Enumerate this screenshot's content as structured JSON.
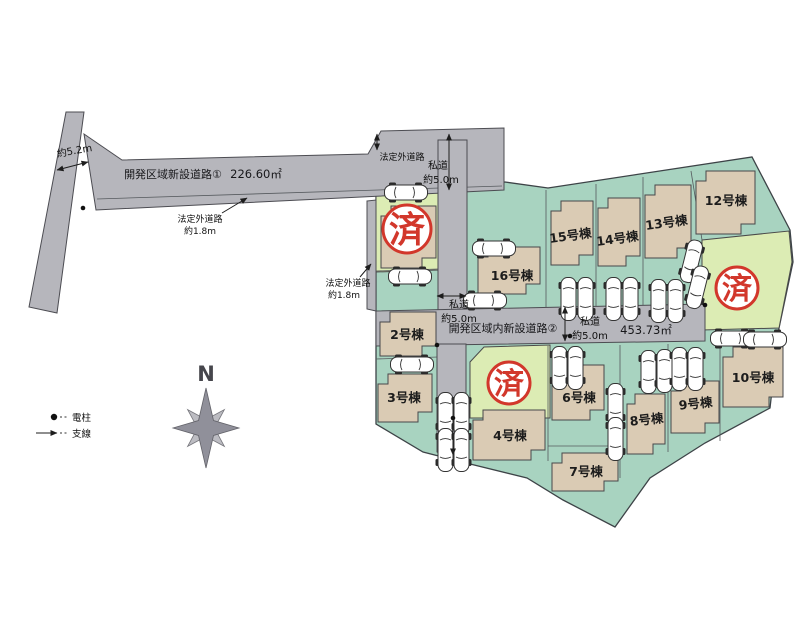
{
  "colors": {
    "lot_green": "#a8d3c0",
    "lot_sold_yellow": "#dcecb4",
    "road_gray": "#b6b6bc",
    "building_tan": "#dacbb4",
    "stamp_red": "#d2372b"
  },
  "roads": {
    "road1_name": "開発区域新設道路①",
    "road1_area": "226.60㎡",
    "road2_name": "開発区域内新設道路②",
    "road2_area": "453.73㎡",
    "private_road": "私道",
    "private_width": "約5.0m",
    "legal_outside_road": "法定外道路",
    "legal_width": "約1.8m",
    "left_road_width": "約5.2m"
  },
  "lots": [
    {
      "label": "2号棟"
    },
    {
      "label": "3号棟"
    },
    {
      "label": "4号棟"
    },
    {
      "label": "6号棟"
    },
    {
      "label": "7号棟"
    },
    {
      "label": "8号棟"
    },
    {
      "label": "9号棟"
    },
    {
      "label": "10号棟"
    },
    {
      "label": "12号棟"
    },
    {
      "label": "13号棟"
    },
    {
      "label": "14号棟"
    },
    {
      "label": "15号棟"
    },
    {
      "label": "16号棟"
    }
  ],
  "sold_stamp": "済",
  "compass": {
    "north": "N"
  },
  "legend": {
    "pole": "電柱",
    "guy_wire": "支線"
  }
}
